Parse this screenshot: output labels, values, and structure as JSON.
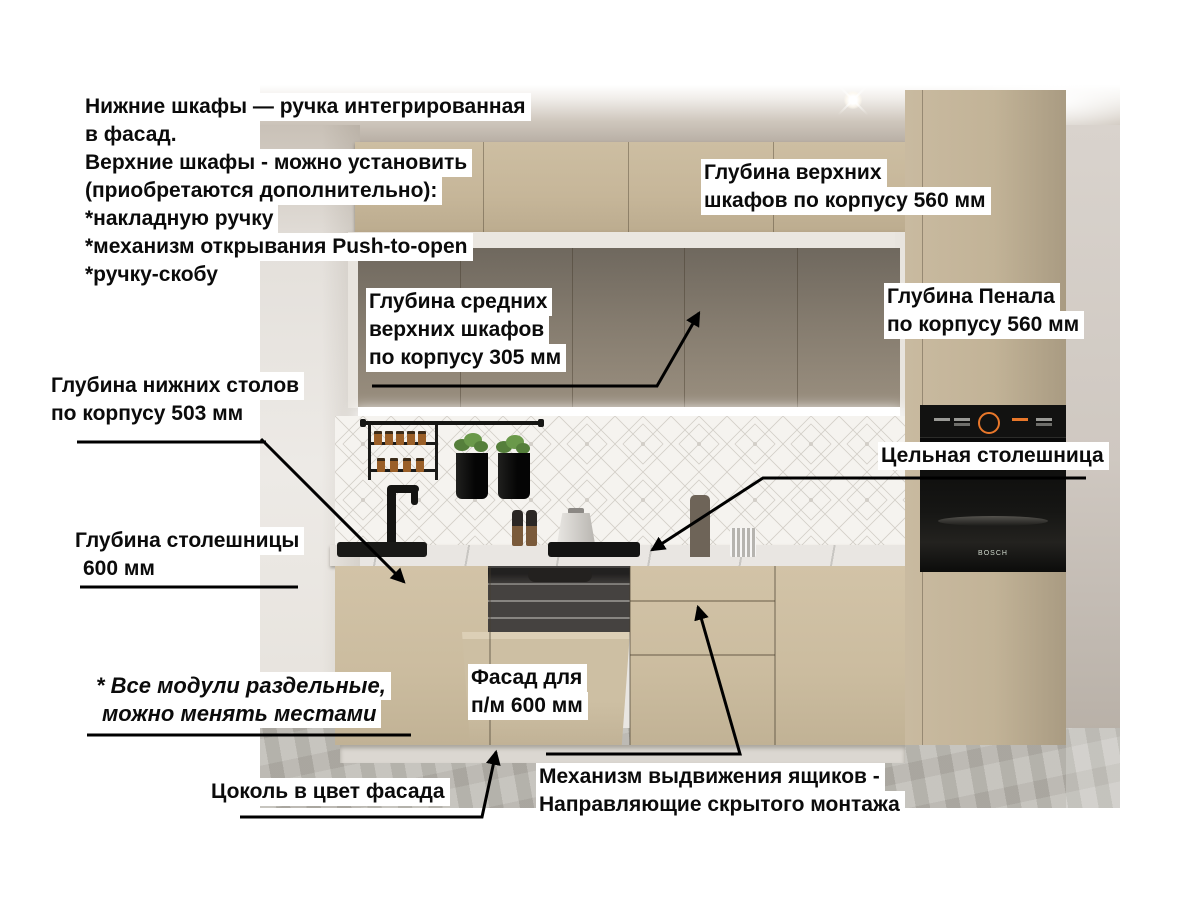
{
  "callouts": {
    "handles_note": {
      "lines": [
        "Нижние шкафы — ручка интегрированная",
        "в фасад.",
        "Верхние шкафы - можно установить",
        "(приобретаются дополнительно):",
        "*накладную ручку",
        "*механизм открывания Push-to-open",
        "*ручку-скобу"
      ]
    },
    "upper_depth": {
      "lines": [
        "Глубина верхних",
        "шкафов по корпусу 560 мм"
      ]
    },
    "middle_upper_depth": {
      "lines": [
        "Глубина средних",
        "верхних шкафов",
        "по корпусу 305 мм"
      ]
    },
    "tall_depth": {
      "lines": [
        "Глубина Пенала",
        "по корпусу 560 мм"
      ]
    },
    "base_depth": {
      "lines": [
        "Глубина нижних столов",
        "по корпусу 503 мм"
      ]
    },
    "solid_countertop": {
      "lines": [
        "Цельная столешница"
      ]
    },
    "countertop_depth": {
      "lines": [
        "Глубина столешницы",
        "600 мм"
      ]
    },
    "modules_note": {
      "lines": [
        "* Все модули раздельные,",
        "можно менять местами"
      ]
    },
    "dw_facade": {
      "lines": [
        "Фасад для",
        "п/м 600 мм"
      ]
    },
    "plinth_note": {
      "lines": [
        "Цоколь в цвет фасада"
      ]
    },
    "drawer_mech": {
      "lines": [
        "Механизм выдвижения ящиков -",
        "Направляющие скрытого монтажа"
      ]
    }
  },
  "appliances": {
    "oven_brand": "BOSCH"
  },
  "colors": {
    "cabinet_beige": "#c7b89d",
    "cabinet_gray": "#877e70",
    "countertop": "#edebe7",
    "backsplash": "#f5f3ef",
    "arrow": "#000000",
    "highlight_bg": "#ffffff",
    "text": "#0b0b0b",
    "oven_black": "#0d0d0c",
    "oven_display_accent": "#e8772a"
  }
}
